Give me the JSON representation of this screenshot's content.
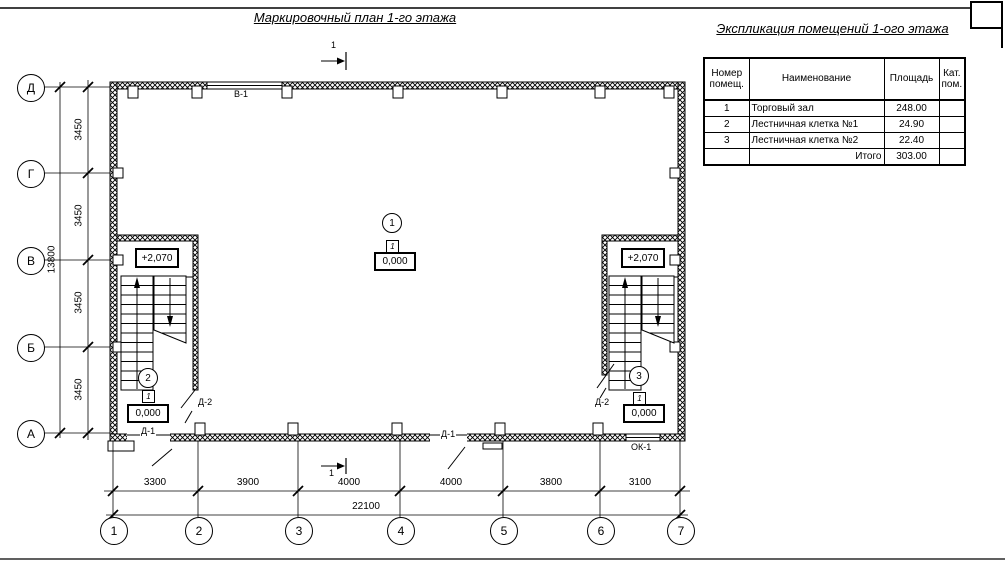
{
  "titles": {
    "plan": "Маркировочный план 1-го этажа",
    "legend": "Экспликация помещений 1-ого этажа"
  },
  "legend_table": {
    "headers": [
      "Номер помещ.",
      "Наименование",
      "Площадь",
      "Кат. пом."
    ],
    "rows": [
      {
        "num": "1",
        "name": "Торговый зал",
        "area": "248.00",
        "cat": ""
      },
      {
        "num": "2",
        "name": "Лестничная клетка №1",
        "area": "24.90",
        "cat": ""
      },
      {
        "num": "3",
        "name": "Лестничная клетка №2",
        "area": "22.40",
        "cat": ""
      }
    ],
    "total_label": "Итого",
    "total_value": "303.00"
  },
  "plan": {
    "row_axes": [
      "Д",
      "Г",
      "В",
      "Б",
      "А"
    ],
    "col_axes": [
      "1",
      "2",
      "3",
      "4",
      "5",
      "6",
      "7"
    ],
    "dims_bottom": [
      "3300",
      "3900",
      "4000",
      "4000",
      "3800",
      "3100"
    ],
    "total_width": "22100",
    "dims_left": [
      "3450",
      "3450",
      "3450",
      "3450"
    ],
    "total_height": "13800",
    "section_mark": "1",
    "labels": {
      "window_top": "В-1",
      "door_outer": "Д-1",
      "door_inner": "Д-2",
      "window_right": "ОК-1"
    },
    "levels": {
      "landing": "+2,070",
      "ground": "0,000"
    },
    "room_tags": [
      "1",
      "2",
      "3"
    ],
    "floor_type_mark": "1"
  }
}
